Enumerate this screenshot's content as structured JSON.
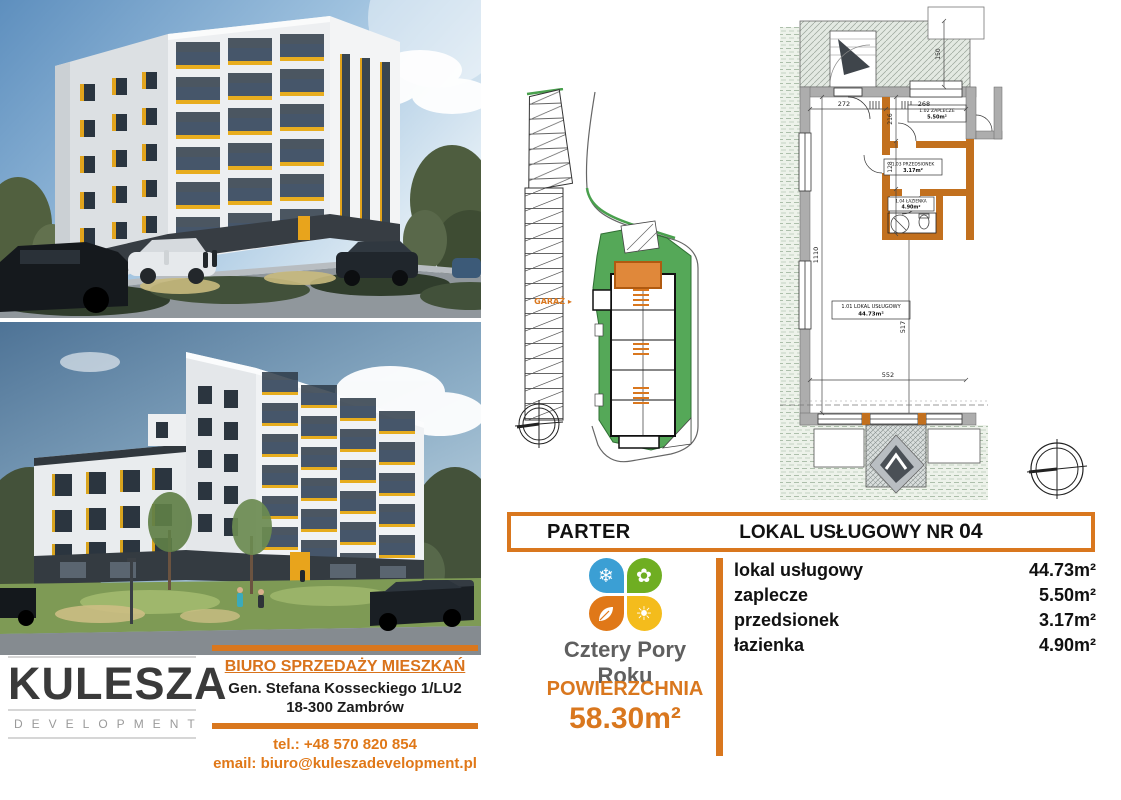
{
  "colors": {
    "orange": "#D9771E",
    "green": "#55A858",
    "charcoal": "#3A3A3A",
    "yellow_accent": "#E8AD1F"
  },
  "developer": {
    "name": "KULESZA",
    "subtitle": "DEVELOPMENT"
  },
  "sales_office": {
    "title": "BIURO SPRZEDAŻY MIESZKAŃ",
    "address_line1": "Gen. Stefana Kosseckiego 1/LU2",
    "address_line2": "18-300 Zambrów",
    "phone": "tel.: +48 570 820 854",
    "email": "email: biuro@kuleszadevelopment.pl"
  },
  "project": {
    "logo_text": "Cztery Pory Roku"
  },
  "icons": {
    "snowflake": "❄",
    "flower": "✿",
    "sun": "☀"
  },
  "unit": {
    "floor_label": "PARTER",
    "title": "LOKAL USŁUGOWY NR",
    "number": "04",
    "area_label": "POWIERZCHNIA",
    "area_value": "58.30m²",
    "rooms": [
      {
        "name": "lokal usługowy",
        "area": "44.73m²"
      },
      {
        "name": "zaplecze",
        "area": "5.50m²"
      },
      {
        "name": "przedsionek",
        "area": "3.17m²"
      },
      {
        "name": "łazienka",
        "area": "4.90m²"
      }
    ]
  },
  "site_plan": {
    "garage_label": "GARAŻ ▸"
  },
  "floor_plan": {
    "dims": {
      "d272": "272",
      "d268": "268",
      "d216": "216",
      "d128": "128",
      "d150": "150",
      "d552": "552",
      "d517": "517",
      "d1110": "1110"
    },
    "labels": {
      "zaplecze": {
        "line1": "1.02 ZAPLECZE",
        "line2": "5.50m²"
      },
      "przedsionek": {
        "line1": "1.03 PRZEDSIONEK",
        "line2": "3.17m²"
      },
      "lazienka": {
        "line1": "1.04 ŁAZIENKA",
        "line2": "4.90m²"
      },
      "lokal": {
        "line1": "1.01 LOKAL USŁUGOWY",
        "line2": "44.73m²"
      }
    }
  }
}
